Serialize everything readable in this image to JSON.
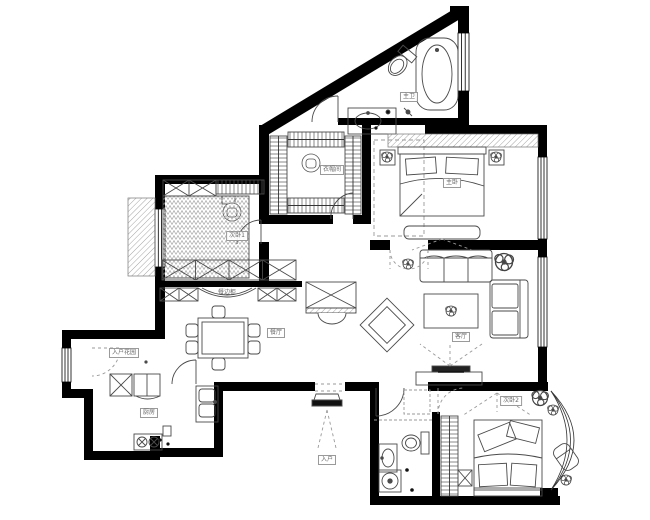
{
  "rooms": [
    {
      "id": "master-bath",
      "label": "主卫"
    },
    {
      "id": "master-bedroom",
      "label": "主卧"
    },
    {
      "id": "cloakroom",
      "label": "衣帽间"
    },
    {
      "id": "bedroom-1",
      "label": "次卧1"
    },
    {
      "id": "sideboard",
      "label": "餐边柜"
    },
    {
      "id": "dining-room",
      "label": "餐厅"
    },
    {
      "id": "living-room",
      "label": "客厅"
    },
    {
      "id": "kitchen",
      "label": "厨房"
    },
    {
      "id": "entry-garden",
      "label": "入户花园"
    },
    {
      "id": "bedroom-2",
      "label": "次卧2"
    },
    {
      "id": "entrance",
      "label": "入户"
    }
  ],
  "fixtures": [
    "bathtub-icon",
    "toilet-icon",
    "washbasin-icon",
    "vanity-icon",
    "double-bed-icon",
    "bedside-table-icon",
    "bed-bench-icon",
    "clothes-rack-icon",
    "lounge-chair-icon",
    "desk-shelf-icon",
    "tatami-bed-icon",
    "wardrobe-icon",
    "sideboard-icon",
    "dining-table-icon",
    "piano-icon",
    "rug-icon",
    "sofa-3seat-icon",
    "sofa-2seat-icon",
    "coffee-table-icon",
    "tv-cabinet-icon",
    "plant-icon",
    "fridge-icon",
    "kitchen-cabinet-icon",
    "kitchen-sink-icon",
    "gas-stove-icon",
    "washing-machine-icon",
    "shower-icon",
    "armchair-icon",
    "entry-step-icon",
    "door-icon",
    "window-icon",
    "bay-window-icon"
  ],
  "colors": {
    "wall": "#000000",
    "furniture_line": "#4a4a4a",
    "hatch": "#8c8c8c",
    "label_text": "#666666",
    "background": "#ffffff"
  }
}
